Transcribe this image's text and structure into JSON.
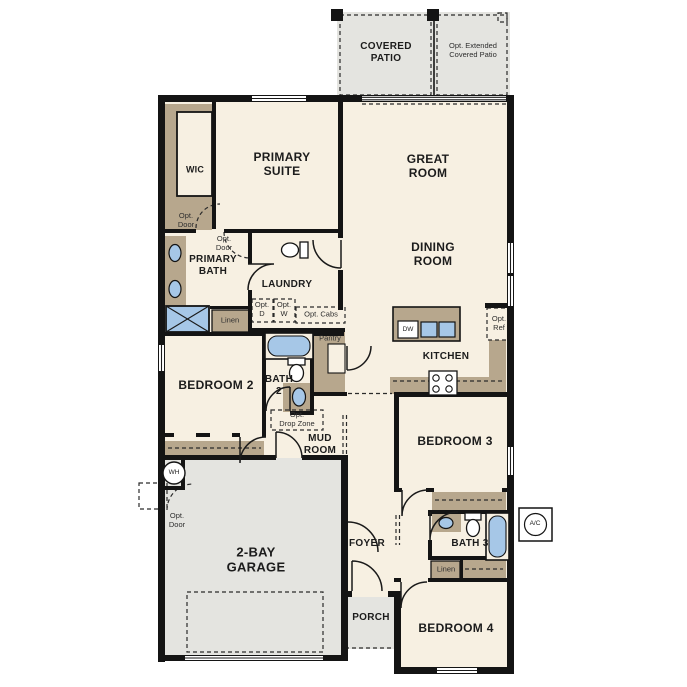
{
  "title": "Single-story floor plan",
  "colors": {
    "floor": "#f7f0e2",
    "exterior_slab": "#e4e4e0",
    "cabinet_tan": "#b7a78d",
    "fixture_blue": "#a6c7e7",
    "wall": "#141414",
    "optional_fill": "#d8d2c2"
  },
  "labels": {
    "covered_patio": "COVERED\nPATIO",
    "opt_extended_patio": "Opt. Extended\nCovered Patio",
    "wic": "WIC",
    "primary_suite": "PRIMARY\nSUITE",
    "great_room": "GREAT\nROOM",
    "opt_door": "Opt.\nDoor",
    "primary_bath": "PRIMARY\nBATH",
    "laundry": "LAUNDRY",
    "dining_room": "DINING\nROOM",
    "opt_d": "Opt.\nD",
    "opt_w": "Opt.\nW",
    "opt_cabs": "Opt. Cabs",
    "linen": "Linen",
    "pantry": "Pantry",
    "opt_ref": "Opt.\nRef",
    "kitchen": "KITCHEN",
    "bedroom2": "BEDROOM 2",
    "bath2": "BATH\n2",
    "opt_drop_zone": "Opt.\nDrop Zone",
    "mud_room": "MUD\nROOM",
    "bedroom3": "BEDROOM 3",
    "wh": "WH",
    "garage": "2-BAY\nGARAGE",
    "foyer": "FOYER",
    "bath3": "BATH 3",
    "ac": "A/C",
    "porch": "PORCH",
    "bedroom4": "BEDROOM 4",
    "dw": "DW"
  }
}
